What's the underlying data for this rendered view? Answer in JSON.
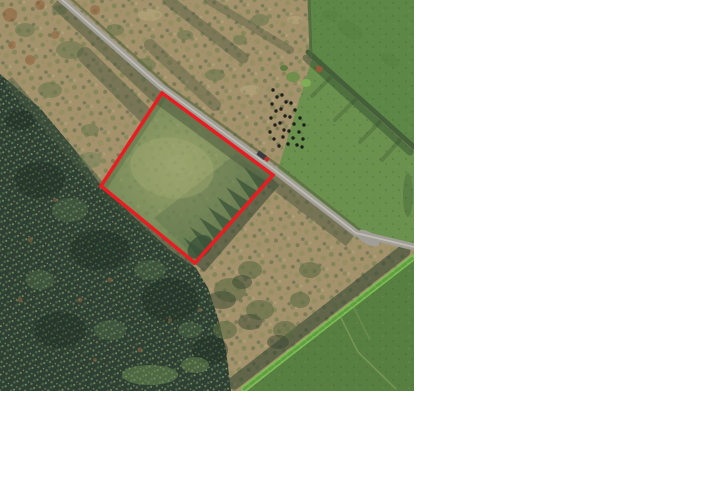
{
  "window": {
    "background_color": "#ffffff",
    "width": 720,
    "height": 480
  },
  "photo": {
    "name": "aerial-site-photo",
    "left": 0,
    "top": 0,
    "width": 414,
    "height": 391,
    "scene_elements": [
      "conifer-forest-bottom-left",
      "brown-scrubland-top-left",
      "green-pasture-fields-right",
      "diagonal-rural-road",
      "road-junction-right",
      "hedgerow-boundaries",
      "silage-bale-cluster",
      "vehicle-on-road",
      "outlined-sale-plot"
    ]
  },
  "annotation": {
    "plot_boundary": {
      "shape": "polygon",
      "points": "162,93 273,175 195,263 101,186",
      "color": "#ea1c21",
      "stroke_width": 3.5
    }
  },
  "palette": {
    "scrub": "#a3926c",
    "forest": "#2e4033",
    "field_top": "#5d8746",
    "field_mid": "#6a924e",
    "field_bottom": "#587f42",
    "hedge_bright": "#7abf53",
    "road": "#a09e97",
    "road_center": "#c7c3b8",
    "shadow": "#49563d",
    "boundary_red": "#ea1c21",
    "car_body": "#3a3a40",
    "car_detail": "#c22b2b",
    "bales": "#141414"
  }
}
